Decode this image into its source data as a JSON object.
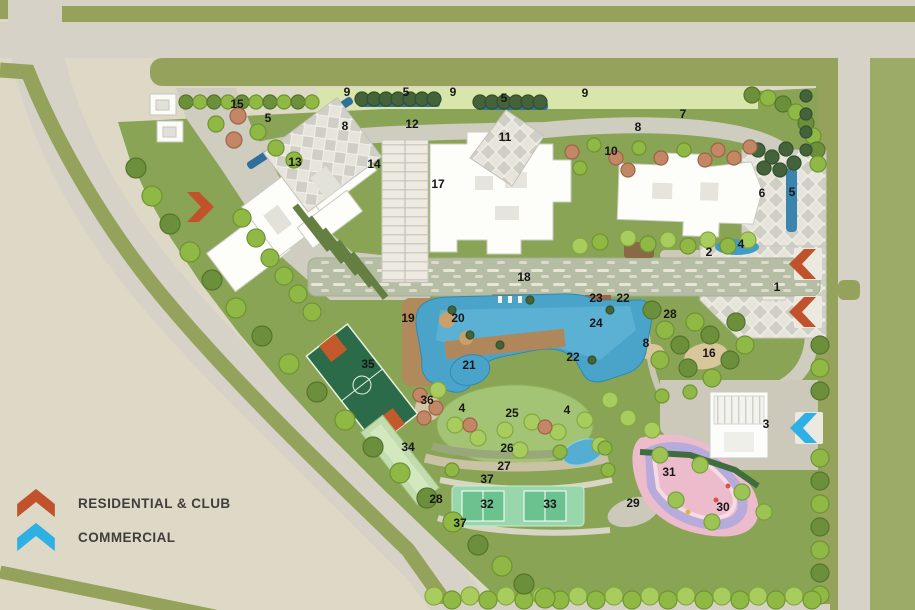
{
  "legend": {
    "items": [
      {
        "id": "residential",
        "label": "RESIDENTIAL & CLUB",
        "color": "#c0532b",
        "icon": "chevron-up-icon"
      },
      {
        "id": "commercial",
        "label": "COMMERCIAL",
        "color": "#2eb0e4",
        "icon": "chevron-up-icon"
      }
    ]
  },
  "plan": {
    "marker_style": {
      "color": "#161616"
    },
    "map_colors": {
      "road": "#d6d2c7",
      "grass": "#8aa456",
      "pool_water": "#4aa4ca",
      "verge_green": "#95a25c"
    },
    "markers": [
      {
        "n": "9",
        "x": 347,
        "y": 96
      },
      {
        "n": "5",
        "x": 406,
        "y": 96
      },
      {
        "n": "9",
        "x": 453,
        "y": 96
      },
      {
        "n": "5",
        "x": 504,
        "y": 102
      },
      {
        "n": "9",
        "x": 585,
        "y": 97
      },
      {
        "n": "15",
        "x": 237,
        "y": 108
      },
      {
        "n": "5",
        "x": 268,
        "y": 122
      },
      {
        "n": "7",
        "x": 683,
        "y": 118
      },
      {
        "n": "8",
        "x": 345,
        "y": 130
      },
      {
        "n": "12",
        "x": 412,
        "y": 128
      },
      {
        "n": "8",
        "x": 638,
        "y": 131
      },
      {
        "n": "11",
        "x": 505,
        "y": 141
      },
      {
        "n": "10",
        "x": 611,
        "y": 155
      },
      {
        "n": "13",
        "x": 295,
        "y": 166
      },
      {
        "n": "14",
        "x": 374,
        "y": 168
      },
      {
        "n": "17",
        "x": 438,
        "y": 188
      },
      {
        "n": "6",
        "x": 762,
        "y": 197
      },
      {
        "n": "5",
        "x": 792,
        "y": 196
      },
      {
        "n": "2",
        "x": 709,
        "y": 256
      },
      {
        "n": "4",
        "x": 741,
        "y": 248
      },
      {
        "n": "1",
        "x": 777,
        "y": 291
      },
      {
        "n": "18",
        "x": 524,
        "y": 281
      },
      {
        "n": "23",
        "x": 596,
        "y": 302
      },
      {
        "n": "22",
        "x": 623,
        "y": 302
      },
      {
        "n": "28",
        "x": 670,
        "y": 318
      },
      {
        "n": "19",
        "x": 408,
        "y": 322
      },
      {
        "n": "20",
        "x": 458,
        "y": 322
      },
      {
        "n": "24",
        "x": 596,
        "y": 327
      },
      {
        "n": "8",
        "x": 646,
        "y": 347
      },
      {
        "n": "16",
        "x": 709,
        "y": 357
      },
      {
        "n": "22",
        "x": 573,
        "y": 361
      },
      {
        "n": "21",
        "x": 469,
        "y": 369
      },
      {
        "n": "35",
        "x": 368,
        "y": 368
      },
      {
        "n": "36",
        "x": 427,
        "y": 404
      },
      {
        "n": "4",
        "x": 462,
        "y": 412
      },
      {
        "n": "25",
        "x": 512,
        "y": 417
      },
      {
        "n": "4",
        "x": 567,
        "y": 414
      },
      {
        "n": "3",
        "x": 766,
        "y": 428
      },
      {
        "n": "26",
        "x": 507,
        "y": 452
      },
      {
        "n": "34",
        "x": 408,
        "y": 451
      },
      {
        "n": "27",
        "x": 504,
        "y": 470
      },
      {
        "n": "31",
        "x": 669,
        "y": 476
      },
      {
        "n": "37",
        "x": 487,
        "y": 483
      },
      {
        "n": "28",
        "x": 436,
        "y": 503
      },
      {
        "n": "32",
        "x": 487,
        "y": 508
      },
      {
        "n": "33",
        "x": 550,
        "y": 508
      },
      {
        "n": "29",
        "x": 633,
        "y": 507
      },
      {
        "n": "30",
        "x": 723,
        "y": 511
      },
      {
        "n": "37",
        "x": 460,
        "y": 527
      }
    ],
    "entry_arrows": [
      {
        "name": "west-residential-entry-arrow",
        "type": "residential",
        "color": "#c0532b",
        "x": 197,
        "y": 207,
        "dir": "right"
      },
      {
        "name": "east-residential-entry-arrow-upper",
        "type": "residential",
        "color": "#c0532b",
        "x": 806,
        "y": 264,
        "dir": "left"
      },
      {
        "name": "east-residential-entry-arrow-lower",
        "type": "residential",
        "color": "#c0532b",
        "x": 806,
        "y": 312,
        "dir": "left"
      },
      {
        "name": "east-commercial-entry-arrow",
        "type": "commercial",
        "color": "#2eb0e4",
        "x": 807,
        "y": 428,
        "dir": "left"
      }
    ]
  }
}
